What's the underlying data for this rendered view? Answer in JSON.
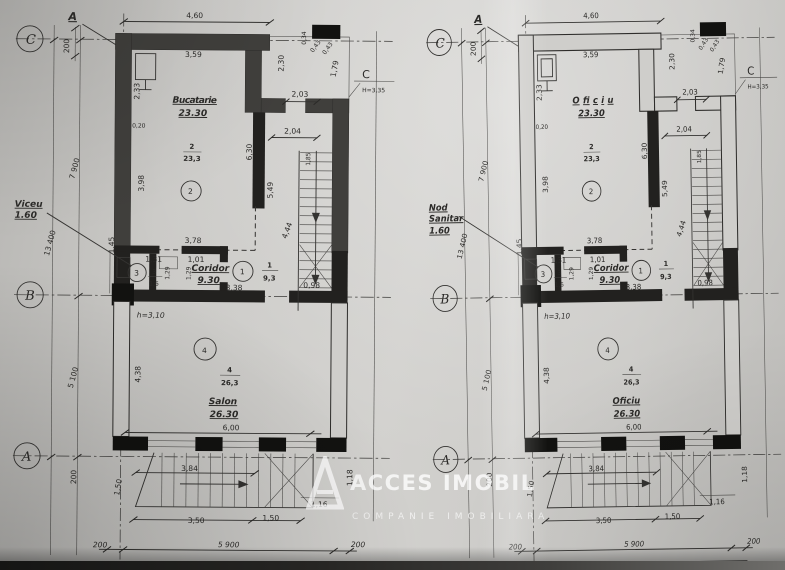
{
  "watermark": {
    "line1": "ACCES IMOBIL",
    "line2": "COMPANIE IMOBILIARA"
  },
  "plans": [
    {
      "axis_top_label": "A",
      "axis_c": "C",
      "axis_b": "B",
      "axis_a": "A",
      "axis_right": "C",
      "axis_right_h": "H=3,35",
      "dim_200_top": "200",
      "dim_460": "4,60",
      "dim_359": "3,59",
      "dim_233": "2,33",
      "dim_020": "0,20",
      "dim_230": "2,30",
      "dim_034": "0,34",
      "dim_043a": "0,43",
      "dim_043b": "0,43",
      "dim_179": "1,79",
      "dim_203": "2,03",
      "dim_204": "2,04",
      "room2_name": "Bucatarie",
      "room2_area": "23.30",
      "room2_num": "2",
      "room2_frac_top": "2",
      "room2_frac_bot": "23,3",
      "dim_398": "3,98",
      "dim_630": "6,30",
      "dim_549": "5,49",
      "dim_185": "1,85",
      "dim_444": "4,44",
      "dim_378": "3,78",
      "dim_7900": "7 900",
      "dim_13400": "13 400",
      "dim_5100": "5 100",
      "dim_145": "1,45",
      "side_line1": "Viceu",
      "side_line2": "1.60",
      "side_line3": "",
      "dim_131": "1,31",
      "dim_101": "1,01",
      "room3_num": "3",
      "room3_frac_top": "3",
      "room3_frac_bot": "1,6",
      "dim_129a": "1,29",
      "dim_129b": "1,29",
      "corridor_name": "Coridor",
      "corridor_area": "9.30",
      "room1_num": "1",
      "room1_frac_top": "1",
      "room1_frac_bot": "9,3",
      "dim_338": "3,38",
      "dim_098": "0,98",
      "height_note": "h=3,10",
      "room4_num": "4",
      "room4_frac_top": "4",
      "room4_frac_bot": "26,3",
      "room4_name": "Salon",
      "room4_area": "26.30",
      "dim_438": "4,38",
      "dim_600": "6,00",
      "dim_384": "3,84",
      "dim_150v": "1,50",
      "dim_350": "3,50",
      "dim_150h": "1,50",
      "dim_116": "1,16",
      "dim_118": "1,18",
      "dim_200_a": "200",
      "dim_200_bl": "200",
      "dim_5900": "5 900",
      "dim_200_br": "200",
      "dim_6300": "6 300"
    },
    {
      "axis_top_label": "A",
      "axis_c": "C",
      "axis_b": "B",
      "axis_a": "A",
      "axis_right": "C",
      "axis_right_h": "H=3,35",
      "dim_200_top": "200",
      "dim_460": "4,60",
      "dim_359": "3,59",
      "dim_233": "2,33",
      "dim_020": "0,20",
      "dim_230": "2,30",
      "dim_034": "0,34",
      "dim_043a": "0,43",
      "dim_043b": "0,43",
      "dim_179": "1,79",
      "dim_203": "2,03",
      "dim_204": "2,04",
      "room2_name": "Oficiu",
      "room2_area": "23.30",
      "room2_num": "2",
      "room2_frac_top": "2",
      "room2_frac_bot": "23,3",
      "dim_398": "3,98",
      "dim_630": "6,30",
      "dim_549": "5,49",
      "dim_185": "1,85",
      "dim_444": "4,44",
      "dim_378": "3,78",
      "dim_7900": "7 900",
      "dim_13400": "13 400",
      "dim_5100": "5 100",
      "dim_145": "1,45",
      "side_line1": "Nod",
      "side_line2": "Sanitar",
      "side_line3": "1.60",
      "dim_131": "1,31",
      "dim_101": "1,01",
      "room3_num": "3",
      "room3_frac_top": "3",
      "room3_frac_bot": "1,6",
      "dim_129a": "1,29",
      "dim_129b": "1,29",
      "corridor_name": "Coridor",
      "corridor_area": "9.30",
      "room1_num": "1",
      "room1_frac_top": "1",
      "room1_frac_bot": "9,3",
      "dim_338": "3,38",
      "dim_098": "0,98",
      "height_note": "h=3,10",
      "room4_num": "4",
      "room4_frac_top": "4",
      "room4_frac_bot": "26,3",
      "room4_name": "Oficiu",
      "room4_area": "26.30",
      "dim_438": "4,38",
      "dim_600": "6,00",
      "dim_384": "3,84",
      "dim_150v": "1,50",
      "dim_350": "3,50",
      "dim_150h": "1,50",
      "dim_116": "1,16",
      "dim_118": "1,18",
      "dim_200_a": "200",
      "dim_200_bl": "200",
      "dim_5900": "5 900",
      "dim_200_br": "200",
      "dim_6300": "6 300"
    }
  ]
}
